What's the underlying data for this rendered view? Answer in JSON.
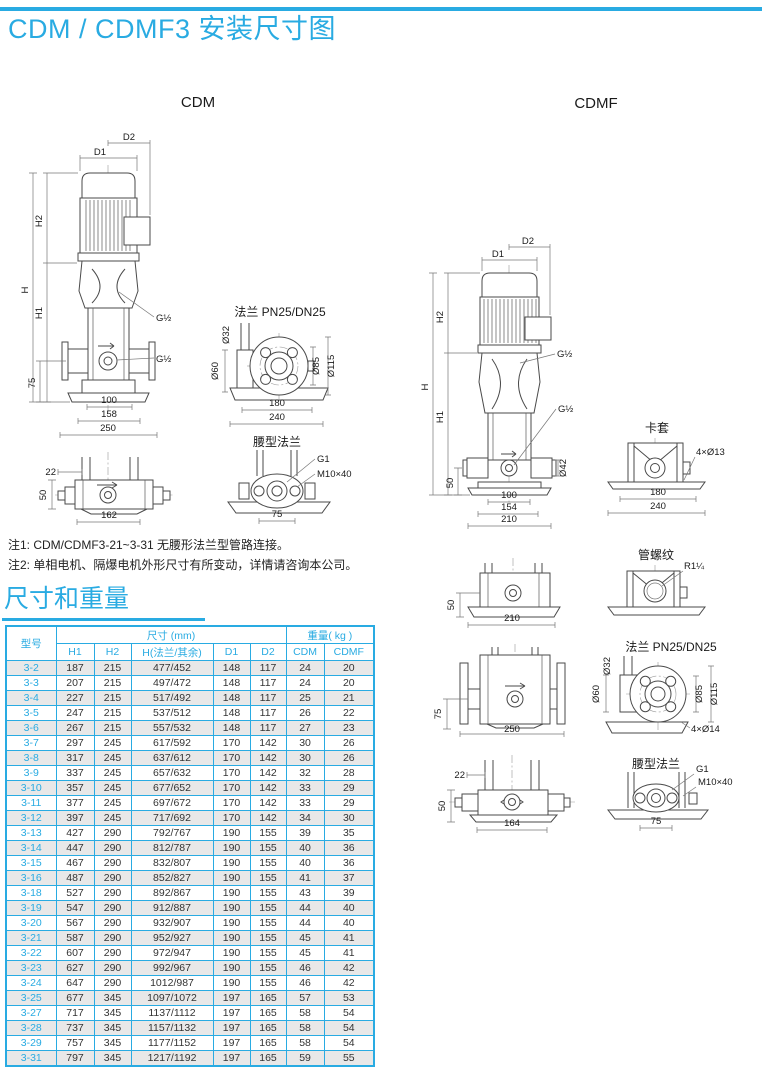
{
  "page": {
    "title": "CDM / CDMF3 安装尺寸图"
  },
  "colors": {
    "accent": "#29abe2",
    "stripe": "#e8e8e8",
    "line": "#4a4a4a"
  },
  "drawings": {
    "cdm": {
      "caption": "CDM",
      "dims": {
        "d1": "D1",
        "d2": "D2",
        "h": "H",
        "h1": "H1",
        "h2": "H2",
        "v75": "75",
        "b100": "100",
        "b158": "158",
        "b250": "250",
        "thread_top": "G½",
        "thread_port": "G½"
      },
      "side": {
        "d22": "22",
        "d50": "50",
        "d162": "162"
      },
      "flange": {
        "title": "法兰 PN25/DN25",
        "d32": "Ø32",
        "d60": "Ø60",
        "d85": "Ø85",
        "d115": "Ø115",
        "b180": "180",
        "b240": "240"
      },
      "waist": {
        "title": "腰型法兰",
        "g1": "G1",
        "bolt": "M10×40",
        "d75": "75"
      }
    },
    "cdmf": {
      "caption": "CDMF",
      "dims": {
        "d1": "D1",
        "d2": "D2",
        "h": "H",
        "h1": "H1",
        "h2": "H2",
        "v50": "50",
        "d42": "Ø42",
        "b100": "100",
        "b154": "154",
        "b210": "210",
        "thread_top": "G½",
        "thread_port": "G½"
      },
      "clamp": {
        "title": "卡套",
        "holes": "4×Ø13",
        "b180": "180",
        "b240": "240"
      },
      "view_b": {
        "d50": "50",
        "d210": "210"
      },
      "thread": {
        "title": "管螺纹",
        "r": "R1¼"
      },
      "view_c": {
        "d75": "75",
        "d250": "250"
      },
      "flange": {
        "title": "法兰 PN25/DN25",
        "d32": "Ø32",
        "d60": "Ø60",
        "d85": "Ø85",
        "d115": "Ø115",
        "holes": "4×Ø14"
      },
      "view_d": {
        "d22": "22",
        "d50": "50",
        "d164": "164"
      },
      "waist": {
        "title": "腰型法兰",
        "g1": "G1",
        "bolt": "M10×40",
        "d75": "75"
      }
    }
  },
  "notes": {
    "note1": "注1: CDM/CDMF3-21~3-31 无腰形法兰型管路连接。",
    "note2": "注2: 单相电机、隔爆电机外形尺寸有所变动，详情请咨询本公司。"
  },
  "table": {
    "section_title": "尺寸和重量",
    "col_model": "型号",
    "group_dims": "尺寸 (mm)",
    "group_weight": "重量( kg )",
    "col_h1": "H1",
    "col_h2": "H2",
    "col_h_flange": "H(法兰/其余)",
    "col_d1": "D1",
    "col_d2": "D2",
    "col_cdm": "CDM",
    "col_cdmf": "CDMF",
    "rows": [
      [
        "3-2",
        "187",
        "215",
        "477/452",
        "148",
        "117",
        "24",
        "20"
      ],
      [
        "3-3",
        "207",
        "215",
        "497/472",
        "148",
        "117",
        "24",
        "20"
      ],
      [
        "3-4",
        "227",
        "215",
        "517/492",
        "148",
        "117",
        "25",
        "21"
      ],
      [
        "3-5",
        "247",
        "215",
        "537/512",
        "148",
        "117",
        "26",
        "22"
      ],
      [
        "3-6",
        "267",
        "215",
        "557/532",
        "148",
        "117",
        "27",
        "23"
      ],
      [
        "3-7",
        "297",
        "245",
        "617/592",
        "170",
        "142",
        "30",
        "26"
      ],
      [
        "3-8",
        "317",
        "245",
        "637/612",
        "170",
        "142",
        "30",
        "26"
      ],
      [
        "3-9",
        "337",
        "245",
        "657/632",
        "170",
        "142",
        "32",
        "28"
      ],
      [
        "3-10",
        "357",
        "245",
        "677/652",
        "170",
        "142",
        "33",
        "29"
      ],
      [
        "3-11",
        "377",
        "245",
        "697/672",
        "170",
        "142",
        "33",
        "29"
      ],
      [
        "3-12",
        "397",
        "245",
        "717/692",
        "170",
        "142",
        "34",
        "30"
      ],
      [
        "3-13",
        "427",
        "290",
        "792/767",
        "190",
        "155",
        "39",
        "35"
      ],
      [
        "3-14",
        "447",
        "290",
        "812/787",
        "190",
        "155",
        "40",
        "36"
      ],
      [
        "3-15",
        "467",
        "290",
        "832/807",
        "190",
        "155",
        "40",
        "36"
      ],
      [
        "3-16",
        "487",
        "290",
        "852/827",
        "190",
        "155",
        "41",
        "37"
      ],
      [
        "3-18",
        "527",
        "290",
        "892/867",
        "190",
        "155",
        "43",
        "39"
      ],
      [
        "3-19",
        "547",
        "290",
        "912/887",
        "190",
        "155",
        "44",
        "40"
      ],
      [
        "3-20",
        "567",
        "290",
        "932/907",
        "190",
        "155",
        "44",
        "40"
      ],
      [
        "3-21",
        "587",
        "290",
        "952/927",
        "190",
        "155",
        "45",
        "41"
      ],
      [
        "3-22",
        "607",
        "290",
        "972/947",
        "190",
        "155",
        "45",
        "41"
      ],
      [
        "3-23",
        "627",
        "290",
        "992/967",
        "190",
        "155",
        "46",
        "42"
      ],
      [
        "3-24",
        "647",
        "290",
        "1012/987",
        "190",
        "155",
        "46",
        "42"
      ],
      [
        "3-25",
        "677",
        "345",
        "1097/1072",
        "197",
        "165",
        "57",
        "53"
      ],
      [
        "3-27",
        "717",
        "345",
        "1137/1112",
        "197",
        "165",
        "58",
        "54"
      ],
      [
        "3-28",
        "737",
        "345",
        "1157/1132",
        "197",
        "165",
        "58",
        "54"
      ],
      [
        "3-29",
        "757",
        "345",
        "1177/1152",
        "197",
        "165",
        "58",
        "54"
      ],
      [
        "3-31",
        "797",
        "345",
        "1217/1192",
        "197",
        "165",
        "59",
        "55"
      ]
    ]
  }
}
